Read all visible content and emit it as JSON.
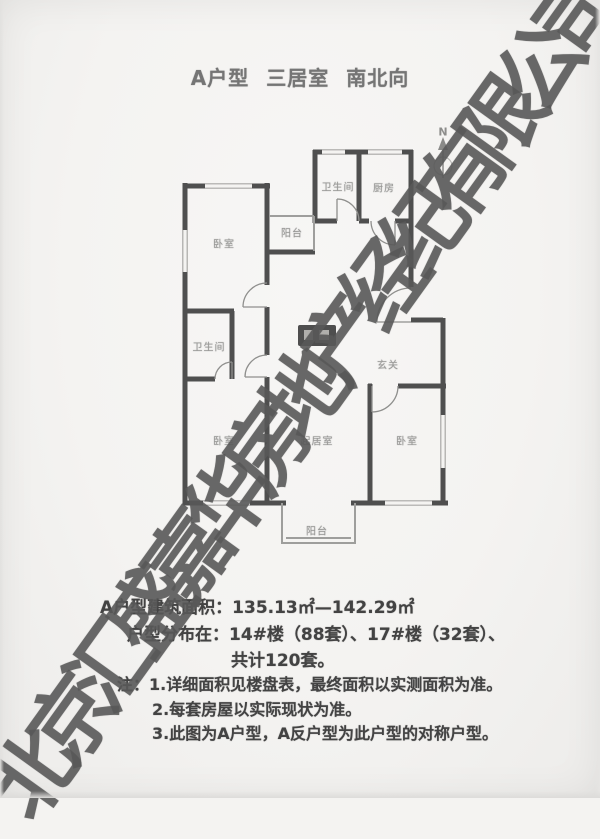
{
  "title": "A户型 三居室 南北向",
  "floor_plan": {
    "compass_label": "N",
    "rooms": [
      {
        "id": "bedroom-nw",
        "label": "卧室"
      },
      {
        "id": "balcony-north",
        "label": "阳台"
      },
      {
        "id": "bathroom-north",
        "label": "卫生间"
      },
      {
        "id": "kitchen",
        "label": "厨房"
      },
      {
        "id": "bathroom-west",
        "label": "卫生间"
      },
      {
        "id": "bedroom-sw",
        "label": "卧室"
      },
      {
        "id": "living-room",
        "label": "起居室"
      },
      {
        "id": "foyer",
        "label": "玄关"
      },
      {
        "id": "bedroom-se",
        "label": "卧室"
      },
      {
        "id": "balcony-south",
        "label": "阳台"
      }
    ]
  },
  "details": {
    "area_line": "A户型建筑面积：135.13㎡—142.29㎡",
    "distribution_line": "户型分布在：14#楼（88套）、17#楼（32套）、",
    "distribution_line2": "共计120套。",
    "notes_label": "注：",
    "notes": [
      "1.详细面积见楼盘表，最终面积以实测面积为准。",
      "2.每套房屋以实际现状为准。",
      "3.此图为A户型，A反户型为此户型的对称户型。"
    ]
  },
  "watermark": {
    "text": "北京汇盛嘉华房地产经纪有限公司",
    "color": "#585858"
  },
  "colors": {
    "wall": "#4f4f4f",
    "paper": "#f4f3f1",
    "room_label": "#9a9a98",
    "body_text": "#434343"
  }
}
